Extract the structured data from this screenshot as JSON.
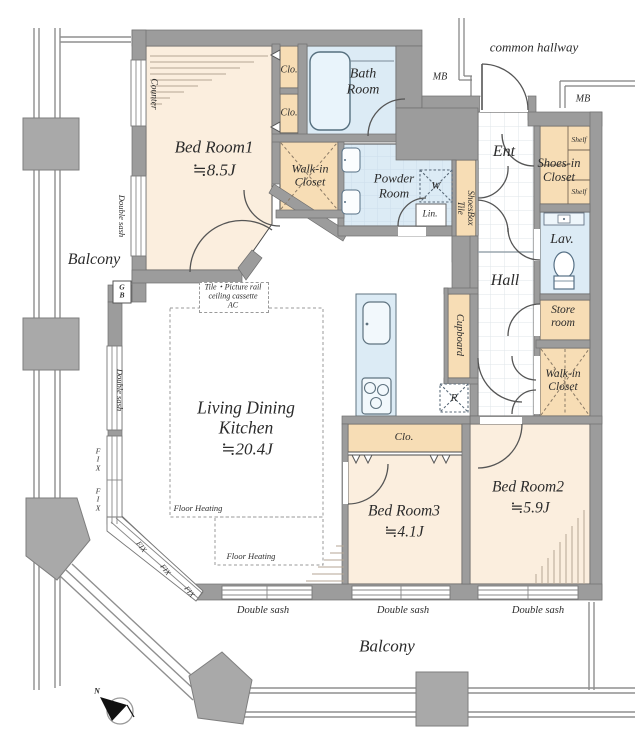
{
  "labels": {
    "common_hallway": "common hallway",
    "mb": "MB",
    "ent": "Ent",
    "shoes_in_closet": "Shoes-in\nCloset",
    "shelf": "Shelf",
    "shoesbox_tile": "ShoesBox\nTile",
    "lav": "Lav.",
    "hall": "Hall",
    "store_room": "Store\nroom",
    "walk_in_closet": "Walk-in\nCloset",
    "cupboard": "Cupboard",
    "fridge": "R",
    "washer": "W",
    "linen": "Lin.",
    "powder_room": "Powder\nRoom",
    "bath_room": "Bath\nRoom",
    "clo": "Clo.",
    "counter": "Counter",
    "gas_box": "G\nB",
    "balcony": "Balcony",
    "bedroom1_name": "Bed Room1",
    "bedroom1_size": "≒8.5J",
    "bedroom2_name": "Bed Room2",
    "bedroom2_size": "≒5.9J",
    "bedroom3_name": "Bed Room3",
    "bedroom3_size": "≒4.1J",
    "ldk_name": "Living Dining\nKitchen",
    "ldk_size": "≒20.4J",
    "floor_heating": "Floor Heating",
    "double_sash": "Double sash",
    "fix": "FIX",
    "fix_stacked": "F\nI\nX",
    "ceiling_note": "Tile・Picture rail\nceiling cassette\nAC",
    "north": "N"
  },
  "colors": {
    "wall": "#9c9c9c",
    "room_cream": "#fbeede",
    "closet_peach": "#f7ddb5",
    "wet_blue": "#dcebf5",
    "outline": "#4a4a4a"
  }
}
